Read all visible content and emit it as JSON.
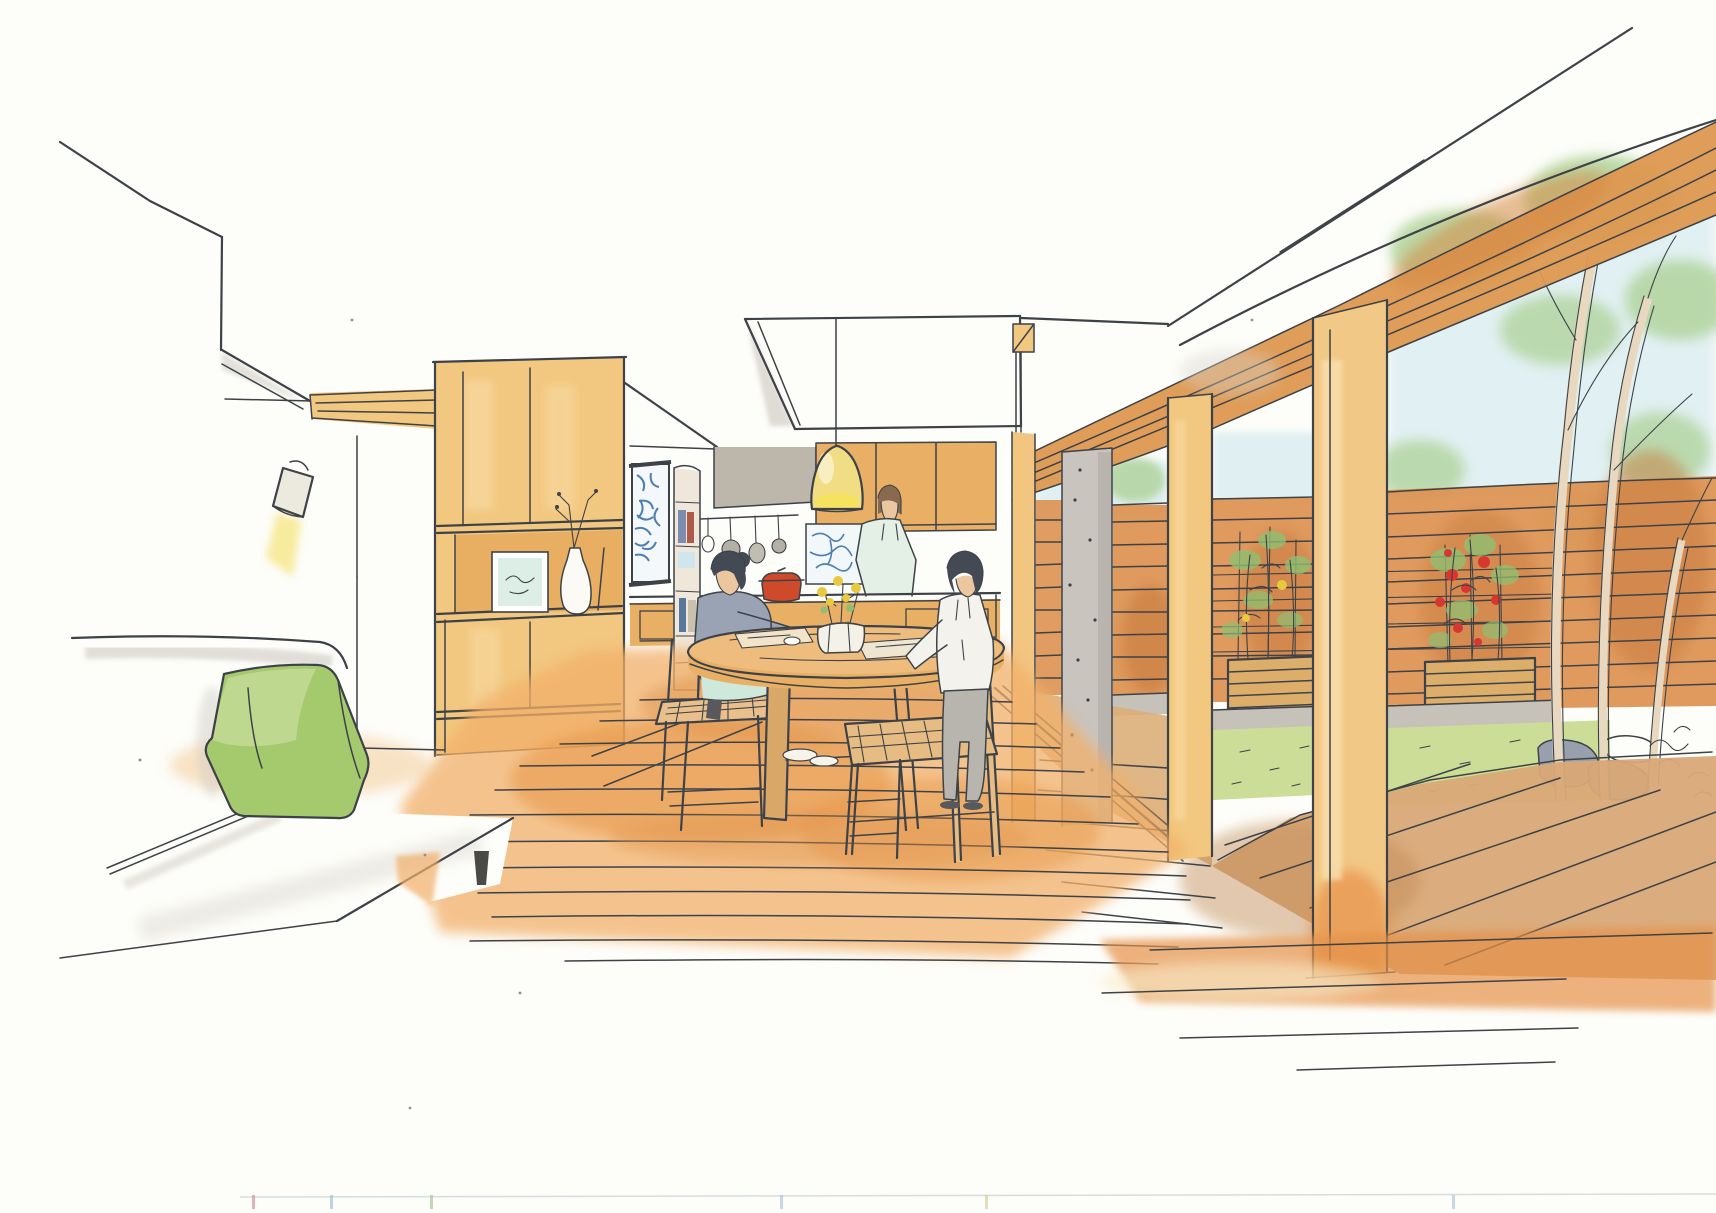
{
  "canvas": {
    "width": 1716,
    "height": 1213,
    "background": "#fdfdf9"
  },
  "palette": {
    "paper": "#fdfdf9",
    "ink": "#3d4248",
    "wood_light": "#f2c77f",
    "wood_mid": "#e9b065",
    "wood_deep": "#dd9850",
    "fence_orange": "#dd9150",
    "fence_shadow": "#c87a3c",
    "floor_orange": "#f2b06a",
    "floor_deep": "#e5924a",
    "deck_tan": "#d9a876",
    "gray_concrete": "#c9c4be",
    "gray_shadow": "#d6d2ca",
    "hood_gray": "#bdb6aa",
    "cushion_green": "#a5c96d",
    "cushion_highlight": "#c8dc9b",
    "lawn_green": "#cbdd97",
    "foliage_green": "#abd093",
    "plant_green": "#8fbf72",
    "sky_blue": "#ddeef1",
    "tomato_red": "#d8372f",
    "pot_red": "#cf4a2a",
    "pendant_yellow": "#f0dd84",
    "lamp_glow": "#f7e88f",
    "art_blue": "#4d7fb3",
    "skin": "#eac79e",
    "hair_dark": "#434a54",
    "hair_brown": "#8a6a4e",
    "sweater_gray": "#9aa3b4",
    "skirt_mint": "#cfe8dc",
    "shirt_white": "#f4f2ec",
    "pants_gray": "#b8b5ae",
    "stone_gray": "#98a0ae"
  },
  "scene": {
    "medium": "ink and marker architectural perspective sketch",
    "setting": "open-plan dining room and kitchen opening onto a wood deck and courtyard garden with slatted fence",
    "figure_count": 3,
    "figures": [
      "cook-at-counter",
      "seated-woman",
      "standing-child"
    ],
    "furniture": [
      "sofa-with-green-cushion",
      "tall-wood-cabinet",
      "round-dining-table",
      "ladder-chairs",
      "kitchen-counter",
      "pendant-lamp",
      "wall-spotlight"
    ],
    "garden": [
      "slat-fence",
      "planter-boxes",
      "tomato-plants",
      "lawn",
      "stones",
      "tree",
      "wood-deck"
    ]
  }
}
